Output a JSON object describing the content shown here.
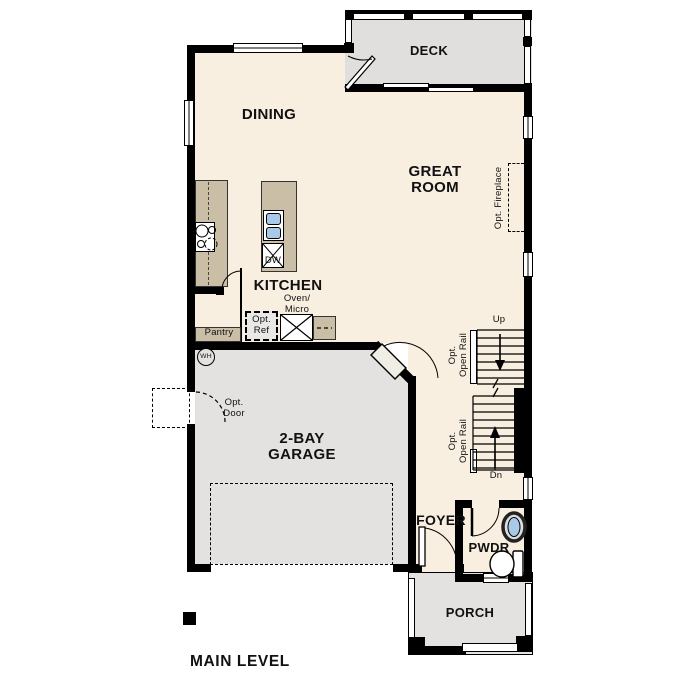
{
  "title": "MAIN LEVEL",
  "rooms": {
    "deck": "DECK",
    "dining": "DINING",
    "great_room_lines": [
      "GREAT",
      "ROOM"
    ],
    "kitchen": "KITCHEN",
    "garage_lines": [
      "2-BAY",
      "GARAGE"
    ],
    "foyer": "FOYER",
    "powder": "PWDR",
    "porch": "PORCH"
  },
  "labels": {
    "up": "Up",
    "down": "Dn",
    "pantry": "Pantry",
    "dishwasher": "DW",
    "water_heater": "WH",
    "oven_micro_lines": [
      "Oven/",
      "Micro"
    ],
    "opt_ref_lines": [
      "Opt.",
      "Ref"
    ],
    "opt_door_lines": [
      "Opt.",
      "Door"
    ],
    "opt_open_rail_lines": [
      "Opt.",
      "Open Rail"
    ],
    "opt_fireplace": "Opt. Fireplace"
  },
  "colors": {
    "floor": "#f8efe1",
    "outdoor": "#e3e2e0",
    "cabinet": "#cabea6",
    "fixture_blue": "#a9c9e9",
    "wall": "#000000"
  }
}
